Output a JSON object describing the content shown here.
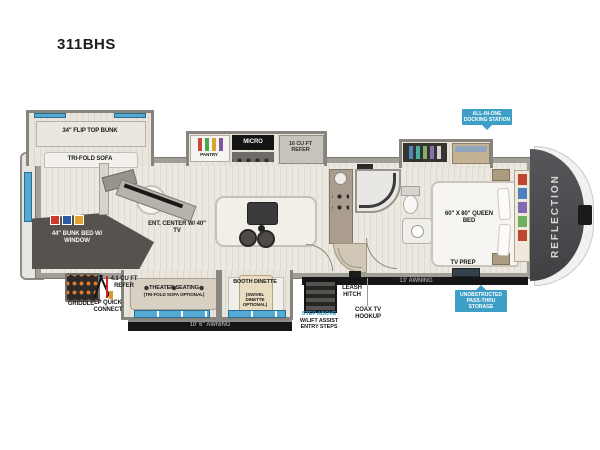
{
  "page": {
    "title": "311BHS"
  },
  "badges": {
    "docking": "ALL-IN-ONE DOCKING STATION",
    "passthru": "UNOBSTRUCTED PASS-THRU STORAGE"
  },
  "rooms": {
    "flip_top_bunk": "34\" FLIP TOP BUNK",
    "tri_fold_sofa": "TRI-FOLD SOFA",
    "bunk_bed": "44\" BUNK BED w/ WINDOW",
    "ent_center": "ENT. CENTER w/ 40\" TV",
    "pantry": "PANTRY",
    "micro": "MICRO",
    "refer_16": "16 CU FT REFER",
    "queen_bed": "60\" x 80\" QUEEN BED",
    "tv_prep": "TV PREP",
    "theater_seating": "THEATER SEATING",
    "theater_seating_option": "(TRI-FOLD SOFA OPTIONAL)",
    "booth_dinette": "BOOTH DINETTE",
    "booth_dinette_option": "(SWIVEL DINETTE OPTIONAL)"
  },
  "exterior": {
    "awning_left": "10' 6\" AWNING",
    "awning_right": "13' AWNING",
    "griddle": "GRIDDLE",
    "refer_41": "4.1 CU FT REFER",
    "lp_quick_connect": "LP QUICK CONNECT",
    "leash_hitch": "LEASH HITCH",
    "coax": "COAX TV HOOKUP",
    "step_above": "STEP ABOVE",
    "step_above_detail": "w/LIFT ASSIST ENTRY STEPS",
    "brand": "REFLECTION"
  },
  "colors": {
    "badge_blue": "#3d9fc6",
    "window_blue": "#55aad4",
    "highlight_blue": "#2e9bc6",
    "front_cap_gray": "#4d4c4f",
    "awning_black": "#161616"
  }
}
